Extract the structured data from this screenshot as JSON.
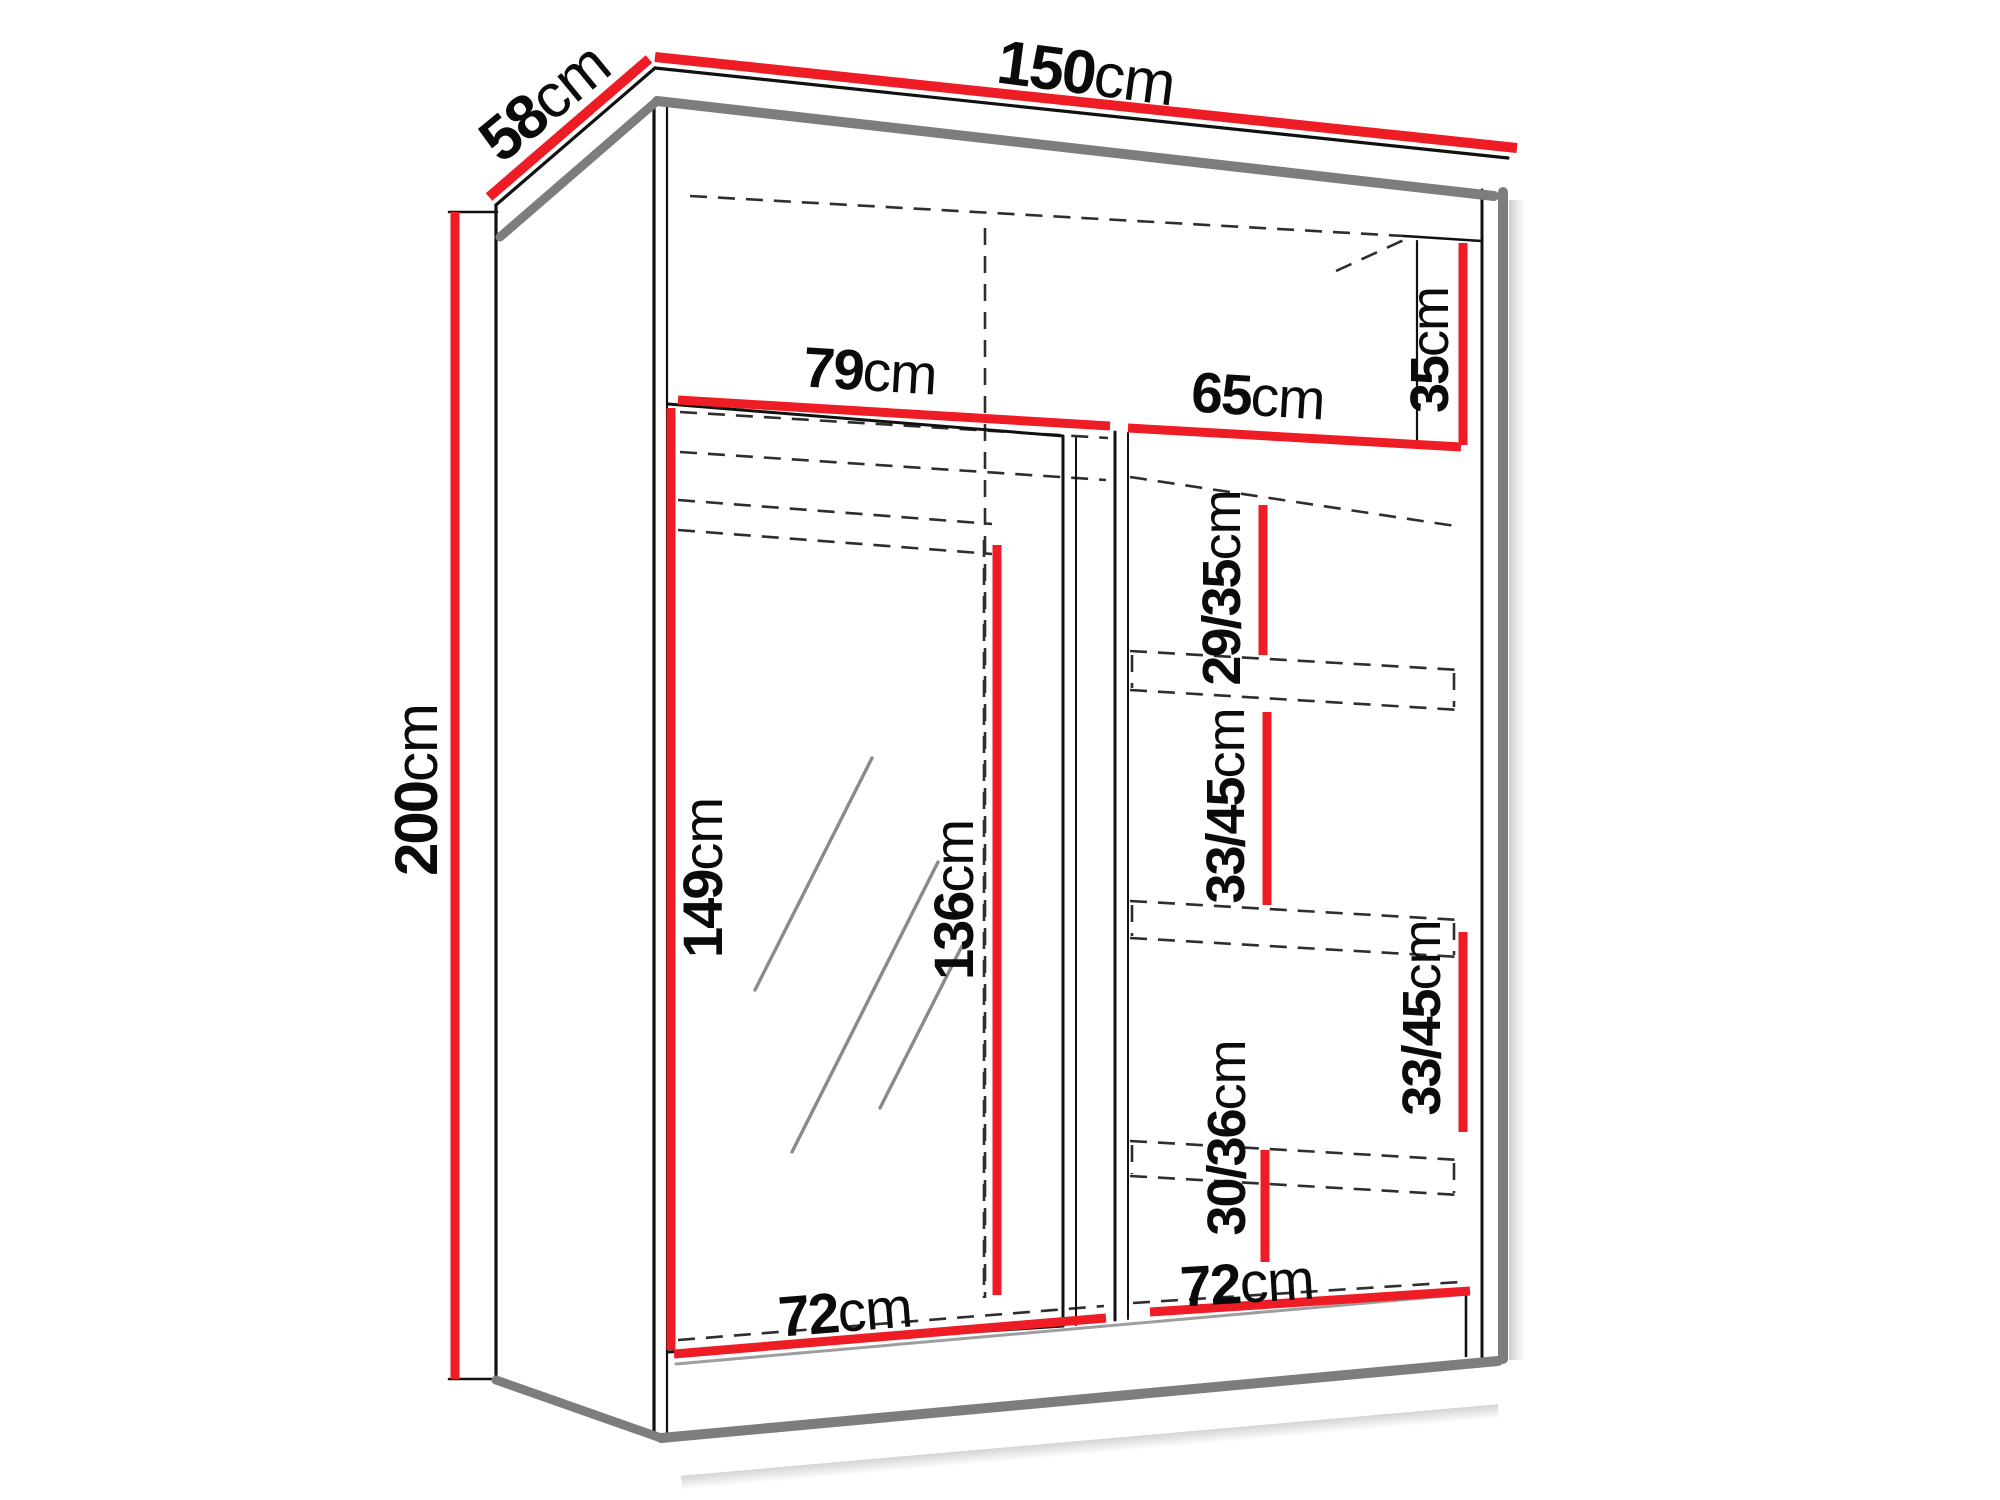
{
  "title": "Wardrobe dimensions diagram",
  "colors": {
    "dimension_line": "#ee1c25",
    "outline": "#111111",
    "panel_edge_gray": "#7d7d7d"
  },
  "dimensions": {
    "width": {
      "value": "150",
      "unit": "cm"
    },
    "depth": {
      "value": "58",
      "unit": "cm"
    },
    "height": {
      "value": "200",
      "unit": "cm"
    },
    "left_top_width": {
      "value": "79",
      "unit": "cm"
    },
    "right_top_width": {
      "value": "65",
      "unit": "cm"
    },
    "top_shelf_height": {
      "value": "35",
      "unit": "cm"
    },
    "shelf2_height": {
      "value": "29/35",
      "unit": "cm"
    },
    "shelf3_height": {
      "value": "33/45",
      "unit": "cm"
    },
    "mirror_height": {
      "value": "149",
      "unit": "cm"
    },
    "hanging_height": {
      "value": "136",
      "unit": "cm"
    },
    "shelf4_height": {
      "value": "33/45",
      "unit": "cm"
    },
    "bottom_shelf_height": {
      "value": "30/36",
      "unit": "cm"
    },
    "left_bottom_width": {
      "value": "72",
      "unit": "cm"
    },
    "right_bottom_width": {
      "value": "72",
      "unit": "cm"
    }
  }
}
